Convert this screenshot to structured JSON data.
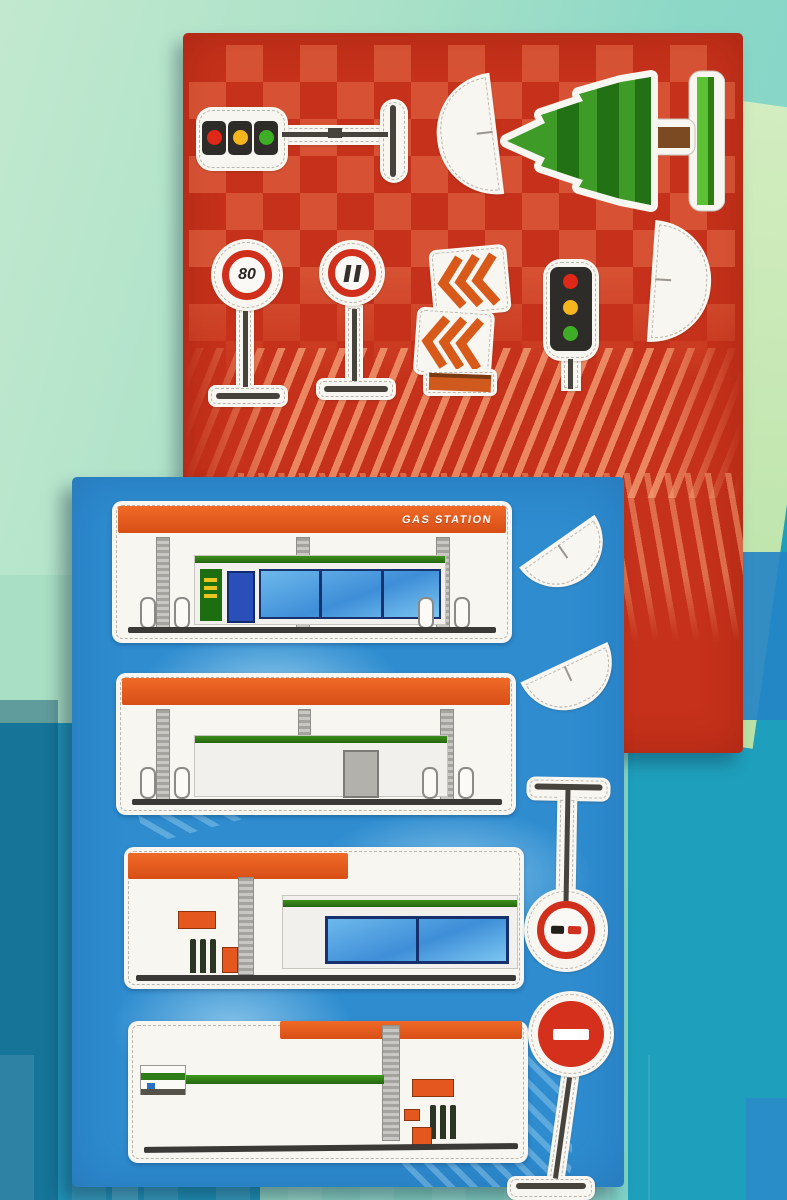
{
  "scene": {
    "type": "photograph",
    "subject": "Two die-cut sticker sheets (traffic signs and gas stations) lying on a mint and teal play mat",
    "sheet_count": 2
  },
  "red_sheet": {
    "base_color": "#c5311a",
    "pattern": "checkerboard with diagonal salmon stripes",
    "speed_sign_value": "80",
    "stickers": [
      "traffic-light-horizontal-with-stand",
      "white-dome-half-flat-right",
      "pine-tree-with-stand",
      "speed-limit-80-sign",
      "no-stopping-sign",
      "chevron-direction-boards",
      "traffic-light-vertical",
      "white-dome-half-flat-left"
    ]
  },
  "blue_sheet": {
    "base_color": "#2e8ccf",
    "station_label": "GAS STATION",
    "stickers": [
      "gas-station-front-with-sign",
      "gas-station-front-plain",
      "gas-station-pumps-and-shop",
      "gas-station-forecourt",
      "white-dome-half-upper",
      "white-dome-half-lower",
      "no-overtaking-sign-inverted",
      "no-entry-sign"
    ]
  },
  "background": {
    "mint_green": "#a9dfc4",
    "aqua": "#7dd2c8",
    "light_green_band": "#c0e6ae",
    "teal": "#1e9fbc",
    "blue_patch": "#2383c5"
  },
  "accent_colors": {
    "sticker_white": "#f8f6f1",
    "canopy_orange": "#e4571e",
    "sign_red": "#cf2f1b",
    "tree_green": "#3f9b28",
    "trim_green": "#2f7d18",
    "light_red": "#e02818",
    "light_yellow": "#f5b51d",
    "light_green": "#3fae27"
  }
}
